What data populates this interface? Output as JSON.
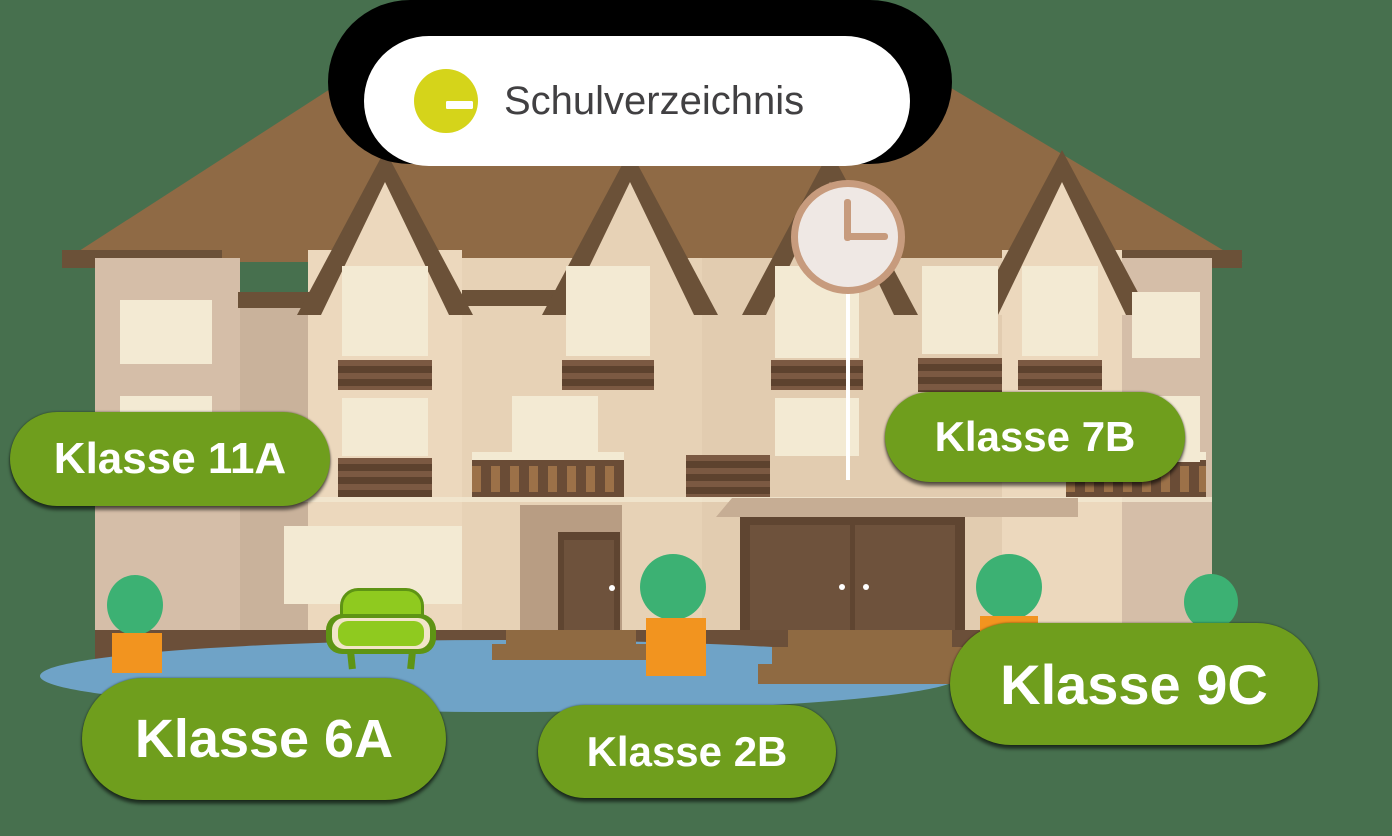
{
  "scene": {
    "width": 1392,
    "height": 836,
    "description": "school building illustration with class directory labels"
  },
  "header": {
    "title": "Schulverzeichnis",
    "icon": "list-icon"
  },
  "clock": {
    "time": "12:15"
  },
  "labels": [
    {
      "id": "11a",
      "text": "Klasse 11A"
    },
    {
      "id": "7b",
      "text": "Klasse 7B"
    },
    {
      "id": "6a",
      "text": "Klasse 6A"
    },
    {
      "id": "2b",
      "text": "Klasse 2B"
    },
    {
      "id": "9c",
      "text": "Klasse 9C"
    }
  ],
  "colors": {
    "bg": "#47704e",
    "roof": "#8f6a45",
    "roof_trim": "#6b5138",
    "facade_light": "#ecd8bd",
    "facade_mid": "#e7d2b6",
    "facade_center": "#e2ccb0",
    "facade_wing": "#d5bea8",
    "facade_recess": "#c9b29b",
    "alcove": "#b89d83",
    "window_frame": "#f3ead3",
    "pane": "#7e96a2",
    "pane_light": "#8ba1ac",
    "louver_dark": "#5d422e",
    "louver_light": "#7b5942",
    "baluster_light": "#9c7148",
    "baluster_dark": "#6a4c36",
    "plinth": "#6b4f39",
    "step": "#8f6a42",
    "door": "#5f4531",
    "door_panel": "#6e523c",
    "porch": "#c6ad94",
    "label_green": "#6f9e1d",
    "label_text": "#ffffff",
    "pill_bg": "#ffffff",
    "icon_circle": "#d5d41a",
    "icon_glyph": "#ffffff",
    "title_text": "#414042",
    "clock_rim": "#c79b7d",
    "clock_face": "#efe8e4",
    "tree": "#3cb173",
    "pot": "#f2941f",
    "ground_blue": "#6fa3c7",
    "couch_light": "#8fca1f",
    "couch_dark": "#5e9414",
    "couch_trim": "#f2e5c9",
    "shadow": "#000000"
  }
}
